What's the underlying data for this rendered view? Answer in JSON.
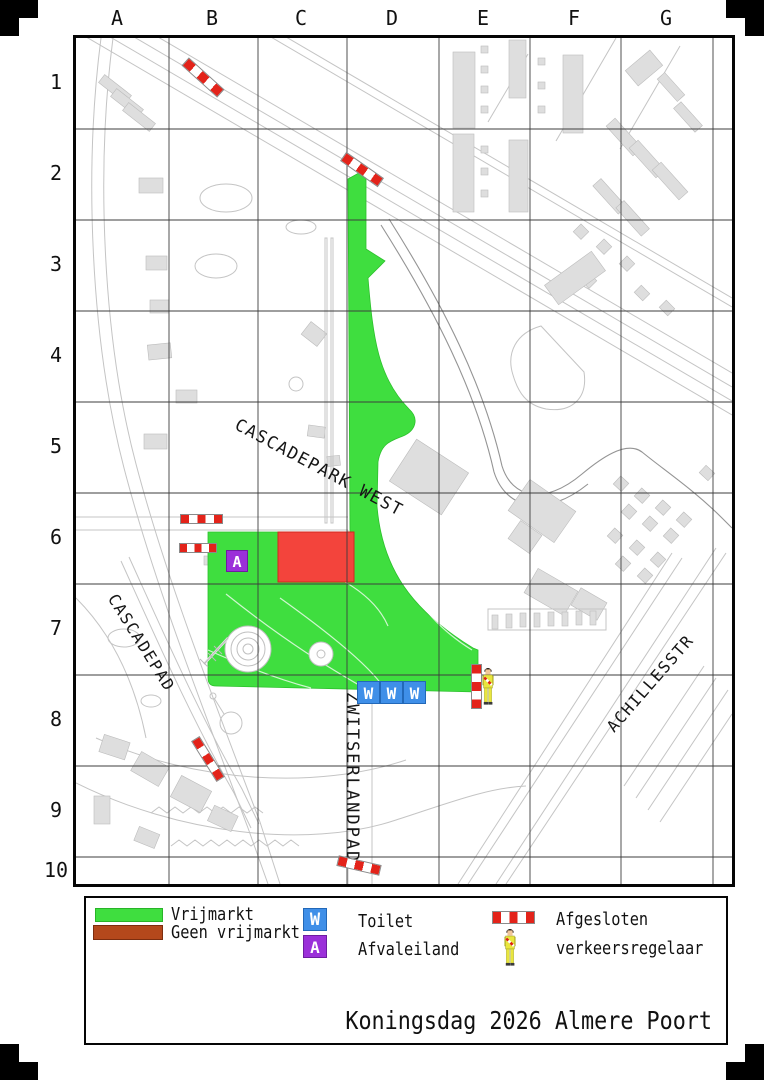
{
  "page": {
    "title": "Koningsdag 2026 Almere Poort"
  },
  "grid": {
    "columns": [
      "A",
      "B",
      "C",
      "D",
      "E",
      "F",
      "G"
    ],
    "rows": [
      "1",
      "2",
      "3",
      "4",
      "5",
      "6",
      "7",
      "8",
      "9",
      "10"
    ]
  },
  "streets": {
    "cascadepark": "CASCADEPARK WEST",
    "cascadepad": "CASCADEPAD",
    "zwitserlandpad": "ZWITSERLANDPAD",
    "achillesstr": "ACHILLESSTR"
  },
  "markers": {
    "toilet_letter": "W",
    "waste_letter": "A"
  },
  "legend": {
    "vrijmarkt": "Vrijmarkt",
    "geen_vrijmarkt": "Geen vrijmarkt",
    "toilet": "Toilet",
    "afvaleiland": "Afvaleiland",
    "afgesloten": "Afgesloten",
    "verkeersregelaar": "verkeersregelaar"
  },
  "colors": {
    "vrijmarkt_green": "#3fde3f",
    "geen_vrijmarkt_map_red": "#f3443c",
    "geen_vrijmarkt_legend_brown": "#b4481c",
    "toilet_blue": "#3f8fe8",
    "afval_purple": "#9b30d9",
    "barrier_red": "#e3231a",
    "regelaar_yellow": "#e9e63e"
  }
}
